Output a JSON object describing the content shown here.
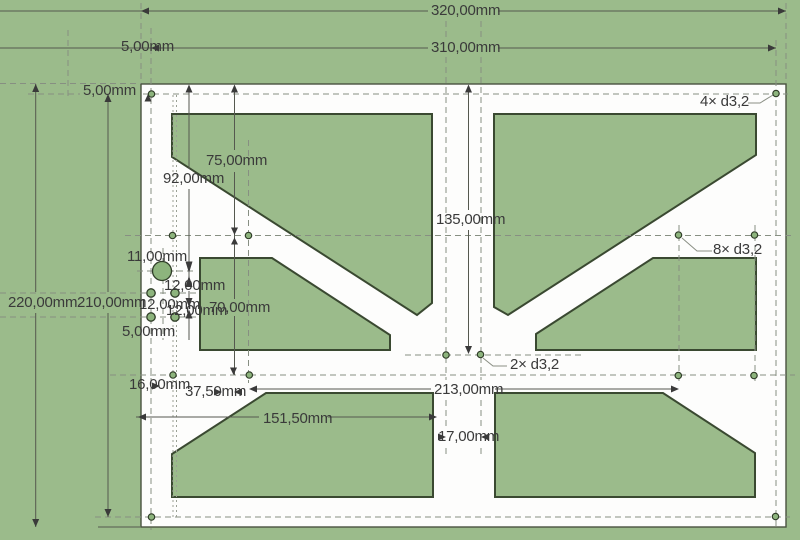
{
  "drawing": {
    "type": "cad-2d-part-drawing",
    "units": "mm",
    "plate": {
      "width_label": "320,00mm",
      "height_label": "220,00mm"
    },
    "colors": {
      "background": "#9bbb8b",
      "pocket_fill": "#9bbb8b",
      "pocket_stroke": "#3a4931",
      "plate_fill": "#fdfdfc",
      "plate_stroke": "#49523f",
      "dashed_line": "#878f82",
      "dim_line": "#55584f",
      "text": "#3a3a3a",
      "hole_fill": "#8db47d",
      "hole_stroke": "#2f3d28"
    }
  },
  "hole_callouts": {
    "corner": "4× d3,2",
    "mid_rows": "8× d3,2",
    "center": "2× d3,2"
  },
  "labels": [
    {
      "id": "dim-320",
      "text": "320,00mm",
      "x": 431,
      "y": 3
    },
    {
      "id": "dim-310",
      "text": "310,00mm",
      "x": 431,
      "y": 40
    },
    {
      "id": "dim-5-top",
      "text": "5,00mm",
      "x": 121,
      "y": 39
    },
    {
      "id": "dim-5-left",
      "text": "5,00mm",
      "x": 83,
      "y": 83
    },
    {
      "id": "dim-75",
      "text": "75,00mm",
      "x": 206,
      "y": 153
    },
    {
      "id": "dim-92",
      "text": "92,00mm",
      "x": 163,
      "y": 171
    },
    {
      "id": "dim-135",
      "text": "135,00mm",
      "x": 436,
      "y": 212
    },
    {
      "id": "dim-11",
      "text": "11,00mm",
      "x": 127,
      "y": 249
    },
    {
      "id": "dim-12-a",
      "text": "12,00mm",
      "x": 164,
      "y": 278
    },
    {
      "id": "dim-220",
      "text": "220,00mm",
      "x": 8,
      "y": 295
    },
    {
      "id": "dim-210",
      "text": "210,00mm",
      "x": 77,
      "y": 295
    },
    {
      "id": "dim-12-b",
      "text": "12,00mm",
      "x": 139,
      "y": 297
    },
    {
      "id": "dim-12-c",
      "text": "12,00mm",
      "x": 166,
      "y": 303
    },
    {
      "id": "dim-70",
      "text": "70,00mm",
      "x": 209,
      "y": 300
    },
    {
      "id": "dim-5-c",
      "text": "5,00mm",
      "x": 122,
      "y": 324
    },
    {
      "id": "callout-2x",
      "text": "2× d3,2",
      "x": 510,
      "y": 357
    },
    {
      "id": "dim-16",
      "text": "16,00mm",
      "x": 129,
      "y": 377
    },
    {
      "id": "dim-37",
      "text": "37,50mm",
      "x": 185,
      "y": 384
    },
    {
      "id": "dim-213",
      "text": "213,00mm",
      "x": 434,
      "y": 382
    },
    {
      "id": "dim-151",
      "text": "151,50mm",
      "x": 263,
      "y": 411
    },
    {
      "id": "dim-17",
      "text": "17,00mm",
      "x": 438,
      "y": 429
    },
    {
      "id": "callout-4x",
      "text": "4× d3,2",
      "x": 700,
      "y": 94
    },
    {
      "id": "callout-8x",
      "text": "8× d3,2",
      "x": 713,
      "y": 242
    }
  ]
}
